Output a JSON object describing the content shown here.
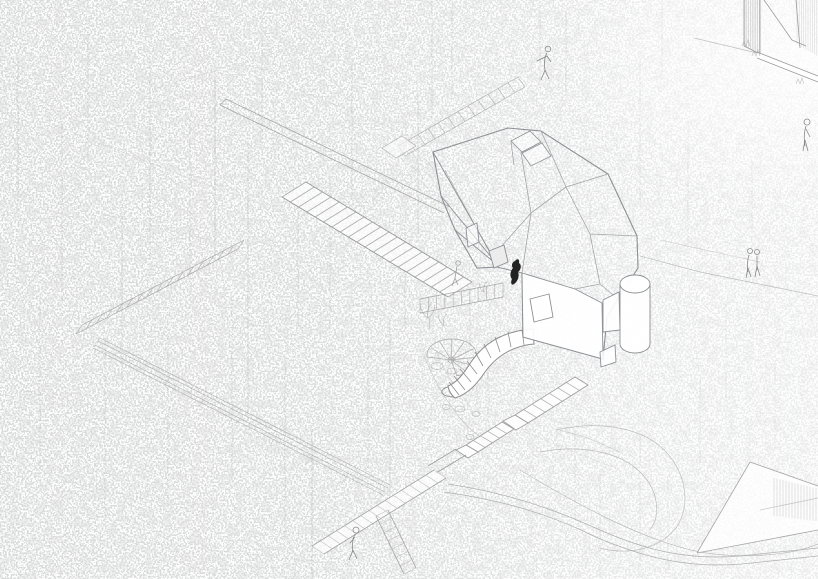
{
  "scene": {
    "description": "Monochrome architectural axonometric line drawing: a faceted polyhedral treehouse pavilion set in a dense pencil-hatched forest, reached by long staircases and a switchback trail, with skylights, an entry hood, a round window wall, a cylindrical volume, a segmented tube slide, a spiral stair, stone steps down to a boardwalk junction, hillside contour lines, deck structures in the corners and small sketched human figures",
    "medium": "pencil-style line drawing, no text",
    "colors": {
      "background": "#ffffff",
      "forest_texture": "#9e9f9f",
      "line_light": "#b3b4b6",
      "line_medium": "#98999c",
      "line_dark": "#7d7e80",
      "climber_figure": "#222222"
    },
    "elements": [
      {
        "name": "forest-texture"
      },
      {
        "name": "tree-trunks"
      },
      {
        "name": "switchback-trail"
      },
      {
        "name": "upper-staircase"
      },
      {
        "name": "main-staircase"
      },
      {
        "name": "handrail-ramp"
      },
      {
        "name": "embankment-hatch"
      },
      {
        "name": "entry-deck-railing"
      },
      {
        "name": "faceted-pavilion"
      },
      {
        "name": "skylights"
      },
      {
        "name": "entry-hood"
      },
      {
        "name": "front-wall-window"
      },
      {
        "name": "cylinder-volume"
      },
      {
        "name": "tube-slide"
      },
      {
        "name": "spiral-stair"
      },
      {
        "name": "stone-steps"
      },
      {
        "name": "boardwalk-junction"
      },
      {
        "name": "hillside-contours"
      },
      {
        "name": "corner-platform"
      },
      {
        "name": "top-right-building"
      },
      {
        "name": "rocks-and-plants"
      }
    ],
    "figures": {
      "people_outline": 6,
      "people_dark_climber": 1
    }
  }
}
